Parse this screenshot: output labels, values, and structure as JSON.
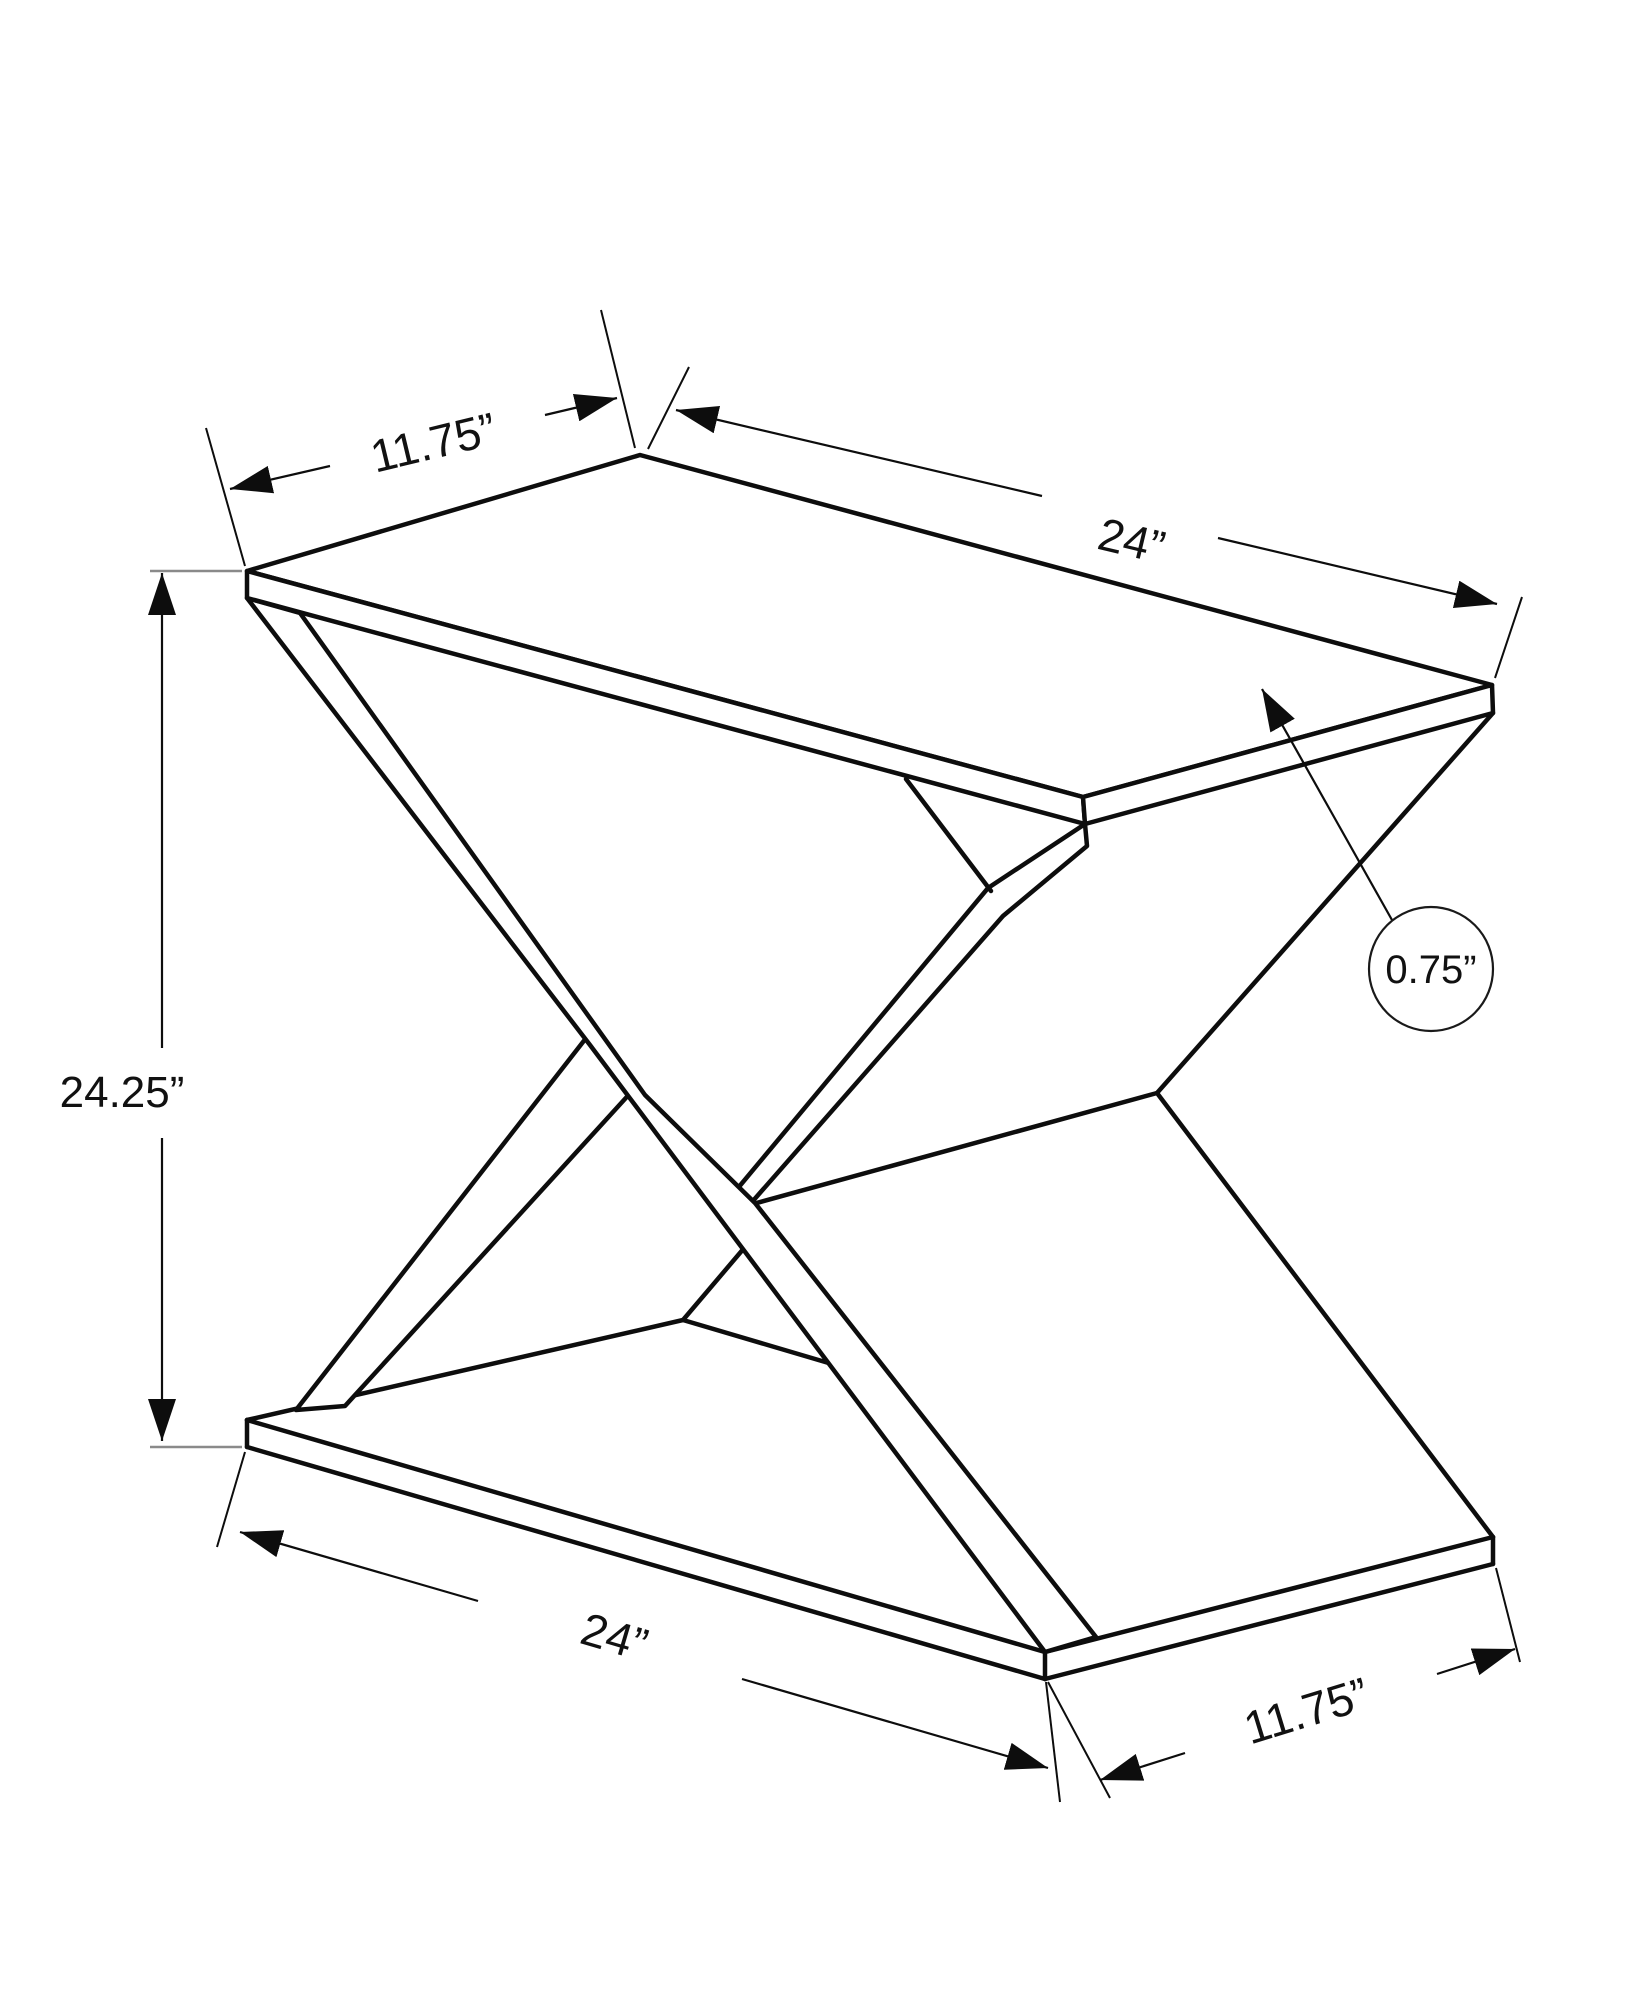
{
  "drawing": {
    "title": "accent-table-dimension-diagram",
    "dimensions": {
      "top_depth": "11.75”",
      "top_width": "24”",
      "height": "24.25”",
      "top_thickness": "0.75”",
      "bottom_width": "24”",
      "bottom_depth": "11.75”"
    },
    "colors": {
      "line": "#0d0d0d",
      "extension_gray": "#8a8a8a",
      "background": "#ffffff"
    }
  }
}
